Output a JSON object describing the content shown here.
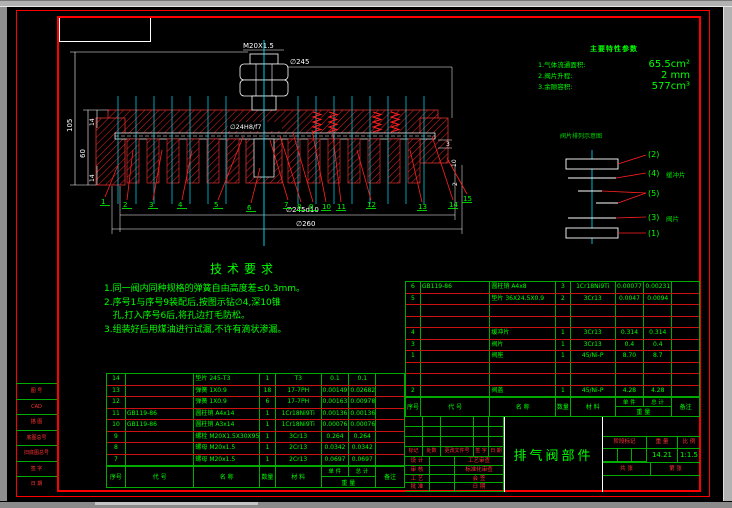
{
  "colors": {
    "line_red": "#ff0000",
    "text_green": "#00ff00",
    "center_cyan": "#00e5ff",
    "dim_white": "#ffffff"
  },
  "drawing": {
    "dims": {
      "thread": "M20X1.5",
      "outer_dia": "∅245",
      "bore_fit": "∅24H8/f7",
      "total_height": "105",
      "mid_height": "60",
      "lip_top": "14",
      "lip_bottom": "14",
      "bolt_circle": "∅245d10",
      "flange_dia": "∅260",
      "step_depth": "3",
      "port_len": "10",
      "gap": "2"
    },
    "part_callouts": [
      "1",
      "2",
      "3",
      "4",
      "5",
      "6",
      "7",
      "8",
      "9",
      "10",
      "11",
      "12",
      "13",
      "14",
      "15"
    ]
  },
  "parameters": {
    "title": "主要特性参数",
    "items": [
      {
        "label": "1.气体流通面积:",
        "value": "65.5cm²"
      },
      {
        "label": "2.阀片升程:",
        "value": "2 mm"
      },
      {
        "label": "3.余隙容积:",
        "value": "577cm³"
      }
    ]
  },
  "plate_diagram": {
    "title": "阀片排列示意图",
    "callouts": [
      {
        "id": "(2)",
        "note": ""
      },
      {
        "id": "(4)",
        "note": "缓冲片"
      },
      {
        "id": "(5)",
        "note": ""
      },
      {
        "id": "(3)",
        "note": "阀片"
      },
      {
        "id": "(1)",
        "note": ""
      }
    ]
  },
  "tech_requirements": {
    "title": "技术要求",
    "lines": [
      "1.同一阀内同种规格的弹簧自由高度差≤0.3mm。",
      "2.序号1与序号9装配后,按图示钻∅4,深10锥",
      "   孔,打入序号6后,将孔边打毛防松。",
      "3.组装好后用煤油进行试漏,不许有滴状渗漏。"
    ]
  },
  "bom_header": {
    "seq": "序号",
    "code": "代  号",
    "name": "名  称",
    "qty": "数量",
    "mat": "材  料",
    "unit": "单 件",
    "total": "总 计",
    "weight": "重  量",
    "remark": "备注"
  },
  "bom_left": {
    "rows": [
      [
        "14",
        "",
        "垫片 245-T3",
        "1",
        "T3",
        "0.1",
        "0.1",
        ""
      ],
      [
        "13",
        "",
        "弹簧 1X0.9",
        "18",
        "17-7PH",
        "0.00149",
        "0.02682",
        ""
      ],
      [
        "12",
        "",
        "弹簧 1X0.9",
        "6",
        "17-7PH",
        "0.00163",
        "0.00978",
        ""
      ],
      [
        "11",
        "GB119-86",
        "圆柱销 A4x14",
        "1",
        "1Cr18Ni9Ti",
        "0.00136",
        "0.00136",
        ""
      ],
      [
        "10",
        "GB119-86",
        "圆柱销 A3x14",
        "1",
        "1Cr18Ni9Ti",
        "0.00076",
        "0.00076",
        ""
      ],
      [
        "9",
        "",
        "螺栓 M20X1.5X30X95-3H",
        "1",
        "3Cr13",
        "0.264",
        "0.264",
        ""
      ],
      [
        "8",
        "",
        "螺母 M20x1.5",
        "1",
        "2Cr13",
        "0.0342",
        "0.0342",
        ""
      ],
      [
        "7",
        "",
        "螺母 M20x1.5",
        "1",
        "2Cr13",
        "0.0697",
        "0.0697",
        ""
      ]
    ]
  },
  "bom_right": {
    "rows": [
      [
        "6",
        "GB119-86",
        "圆柱销 A4x8",
        "3",
        "1Cr18Ni9Ti",
        "0.00077",
        "0.00231",
        ""
      ],
      [
        "5",
        "",
        "垫片 36X24.5X0.9",
        "2",
        "3Cr13",
        "0.0047",
        "0.0094",
        ""
      ],
      [
        "",
        "",
        "",
        "",
        "",
        "",
        "",
        ""
      ],
      [
        "",
        "",
        "",
        "",
        "",
        "",
        "",
        ""
      ],
      [
        "4",
        "",
        "缓冲片",
        "1",
        "3Cr13",
        "0.314",
        "0.314",
        ""
      ],
      [
        "3",
        "",
        "阀片",
        "1",
        "3Cr13",
        "0.4",
        "0.4",
        ""
      ],
      [
        "1",
        "",
        "阀座",
        "1",
        "45/Ni-P",
        "8.70",
        "8.7",
        ""
      ],
      [
        "",
        "",
        "",
        "",
        "",
        "",
        "",
        ""
      ],
      [
        "",
        "",
        "",
        "",
        "",
        "",
        "",
        ""
      ],
      [
        "2",
        "",
        "阀盖",
        "1",
        "45/Ni-P",
        "4.28",
        "4.28",
        ""
      ]
    ]
  },
  "title_block": {
    "title": "排气阀部件",
    "sign_header": [
      "标记",
      "处数",
      "更改文件号",
      "签 字",
      "日 期"
    ],
    "sign_rows": [
      {
        "left": "设 计",
        "right": "工艺审查"
      },
      {
        "left": "审 核",
        "right": "标准化审查"
      },
      {
        "left": "工 艺",
        "right": "会 签"
      },
      {
        "left": "批 准",
        "right": "日 期"
      }
    ],
    "stage_label": "阶段标记",
    "weight_label": "重 量",
    "scale_label": "比 例",
    "weight": "14.21",
    "scale": "1:1.5",
    "sheet_left": "共  张",
    "sheet_right": "第  张"
  },
  "left_margin": {
    "rows": [
      "图 号",
      "CAD",
      "描 图",
      "底图总号",
      "旧底图总号",
      "签 字",
      "日 期"
    ]
  }
}
